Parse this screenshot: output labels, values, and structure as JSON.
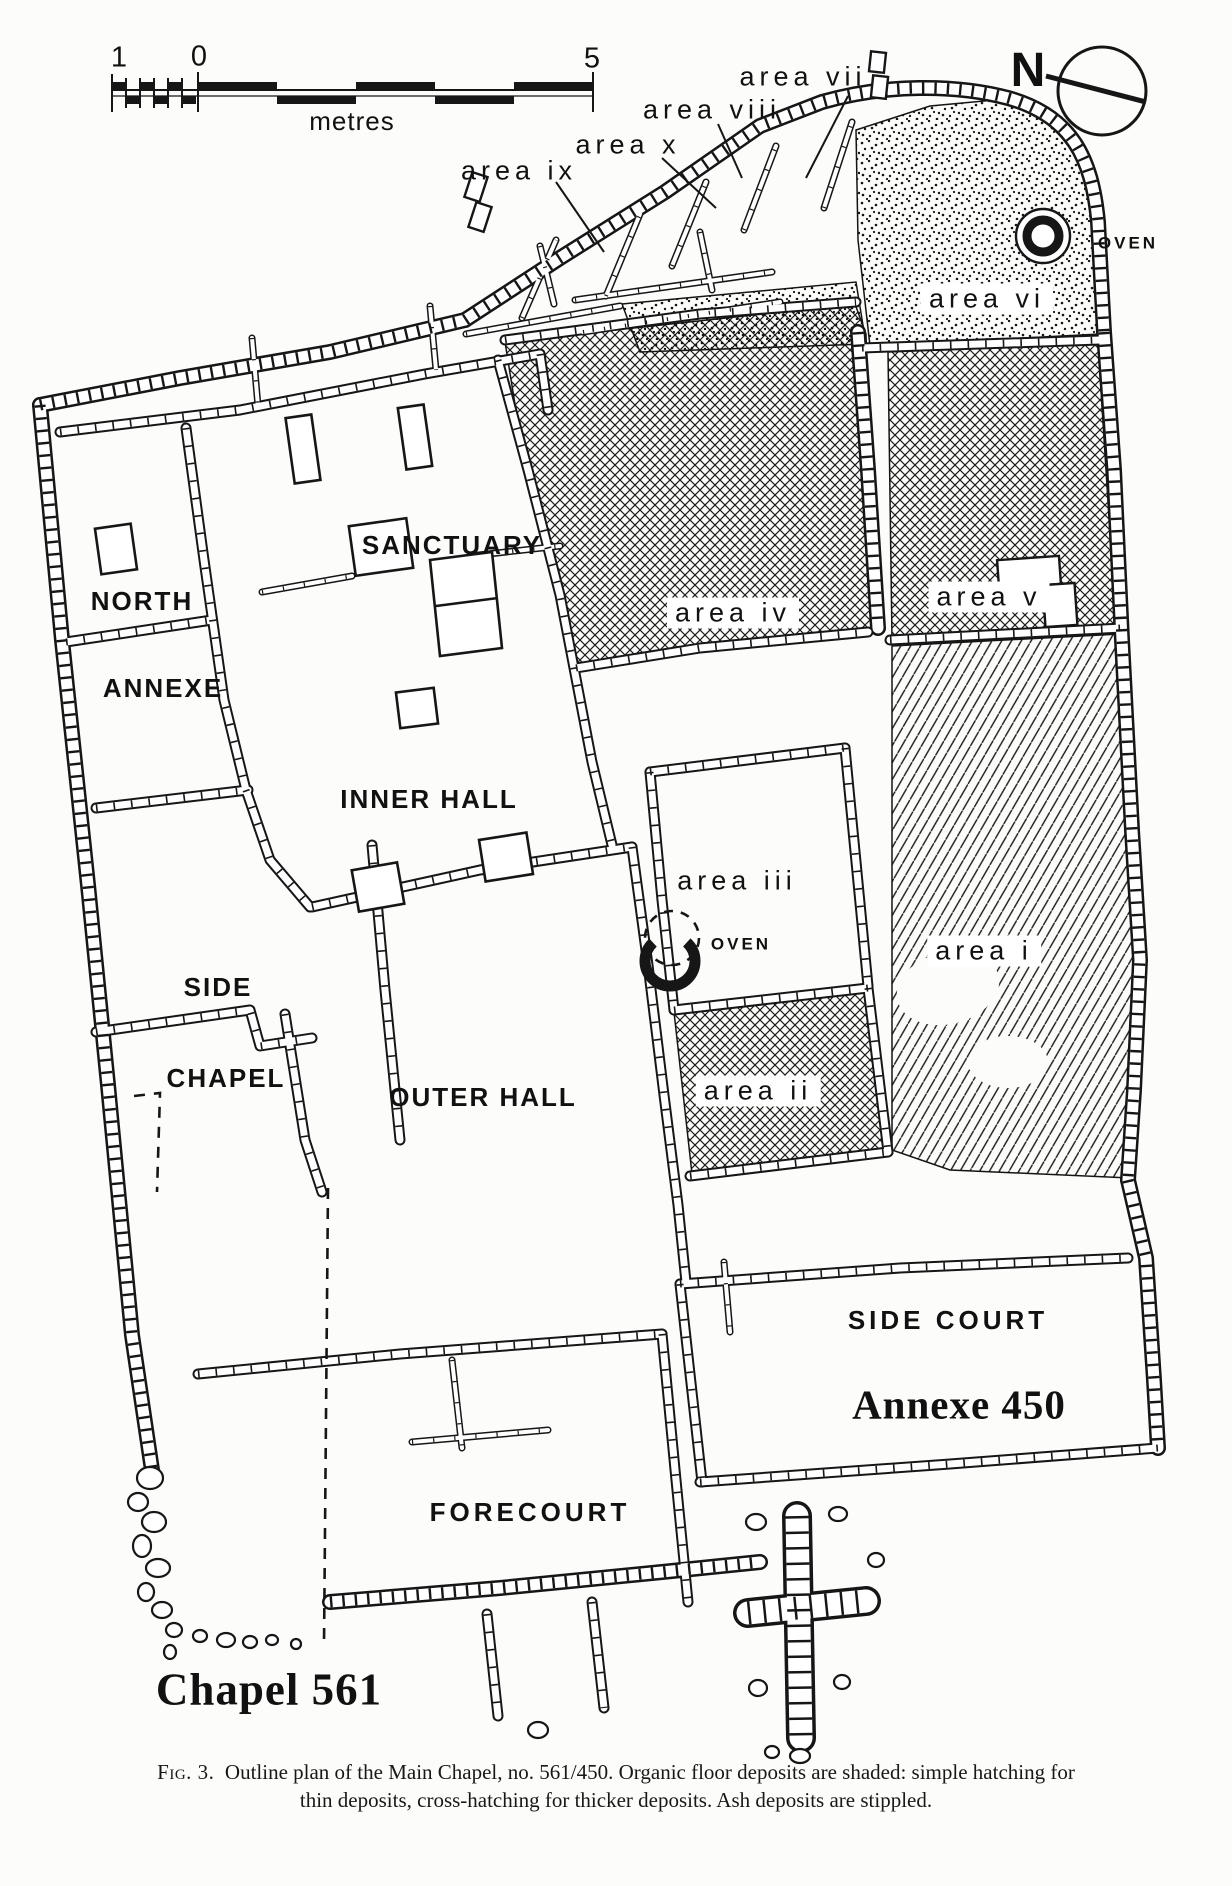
{
  "figure": {
    "scale_bar": {
      "one": "1",
      "zero": "0",
      "five": "5",
      "unit": "metres"
    },
    "compass": {
      "north": "N"
    },
    "ovens": {
      "top": "OVEN",
      "middle": "OVEN"
    },
    "room_labels": {
      "sanctuary": "SANCTUARY",
      "north": "NORTH",
      "annexe": "ANNEXE",
      "inner_hall": "INNER HALL",
      "side": "SIDE",
      "chapel": "CHAPEL",
      "outer_hall": "OUTER HALL",
      "side_court": "SIDE COURT",
      "forecourt": "FORECOURT"
    },
    "area_labels": {
      "i": "area i",
      "ii": "area ii",
      "iii": "area iii",
      "iv": "area iv",
      "v": "area v",
      "vi": "area vi",
      "vii": "area vii",
      "viii": "area viii",
      "ix": "area ix",
      "x": "area x"
    },
    "building_labels": {
      "annexe_450": "Annexe 450",
      "chapel_561": "Chapel 561"
    },
    "caption": {
      "fig_label": "Fig. 3.",
      "line1_rest": "Outline plan of the Main Chapel, no. 561/450. Organic floor deposits are shaded: simple hatching for",
      "line2": "thin deposits, cross-hatching for thicker deposits. Ash deposits are stippled."
    }
  }
}
